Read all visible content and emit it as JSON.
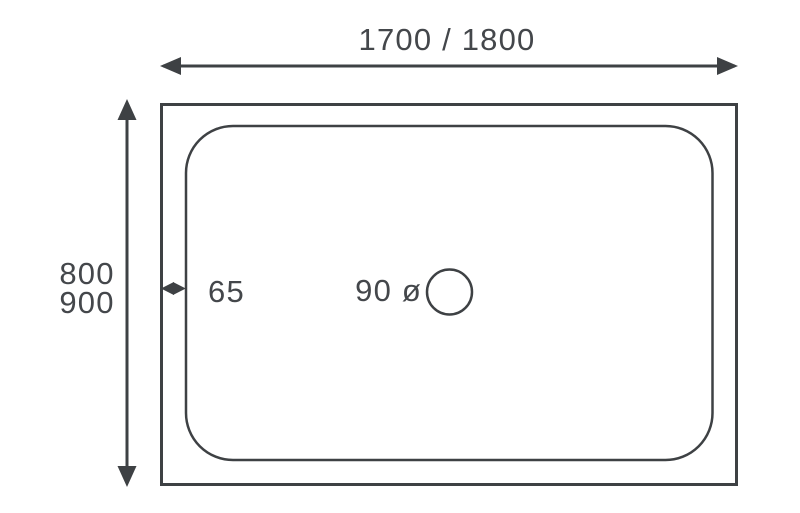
{
  "figure": {
    "colors": {
      "background": "#ffffff",
      "line": "#3e4144",
      "text": "#44474b"
    },
    "labels": {
      "width": "1700 / 1800",
      "depth_line1": "800",
      "depth_line2": "900",
      "edge": "65",
      "drain_diameter": "90 ø"
    }
  }
}
